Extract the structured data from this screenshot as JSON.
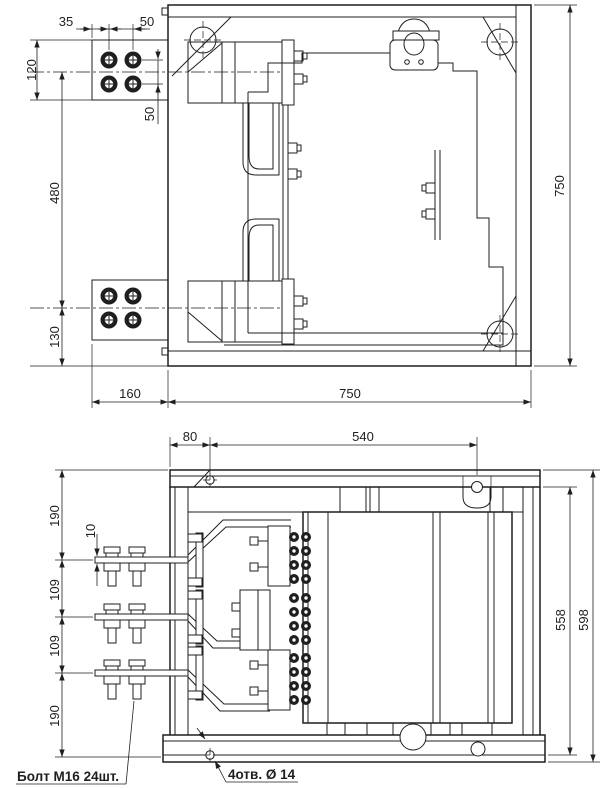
{
  "drawing": {
    "background": "#ffffff",
    "ink": "#1f1f1f",
    "views": {
      "top": {
        "label": "top-view",
        "dims": {
          "d35": "35",
          "d50h": "50",
          "d120": "120",
          "d50v": "50",
          "d480": "480",
          "d130": "130",
          "d160": "160",
          "d750w": "750",
          "d750h": "750"
        }
      },
      "front": {
        "label": "front-view",
        "dims": {
          "d80": "80",
          "d540": "540",
          "d190t": "190",
          "d10": "10",
          "d109a": "109",
          "d109b": "109",
          "d190b": "190",
          "d558": "558",
          "d598": "598"
        },
        "notes": {
          "bolt": "Болт М16 24шт.",
          "holes": "4отв. Ø 14"
        }
      }
    }
  }
}
